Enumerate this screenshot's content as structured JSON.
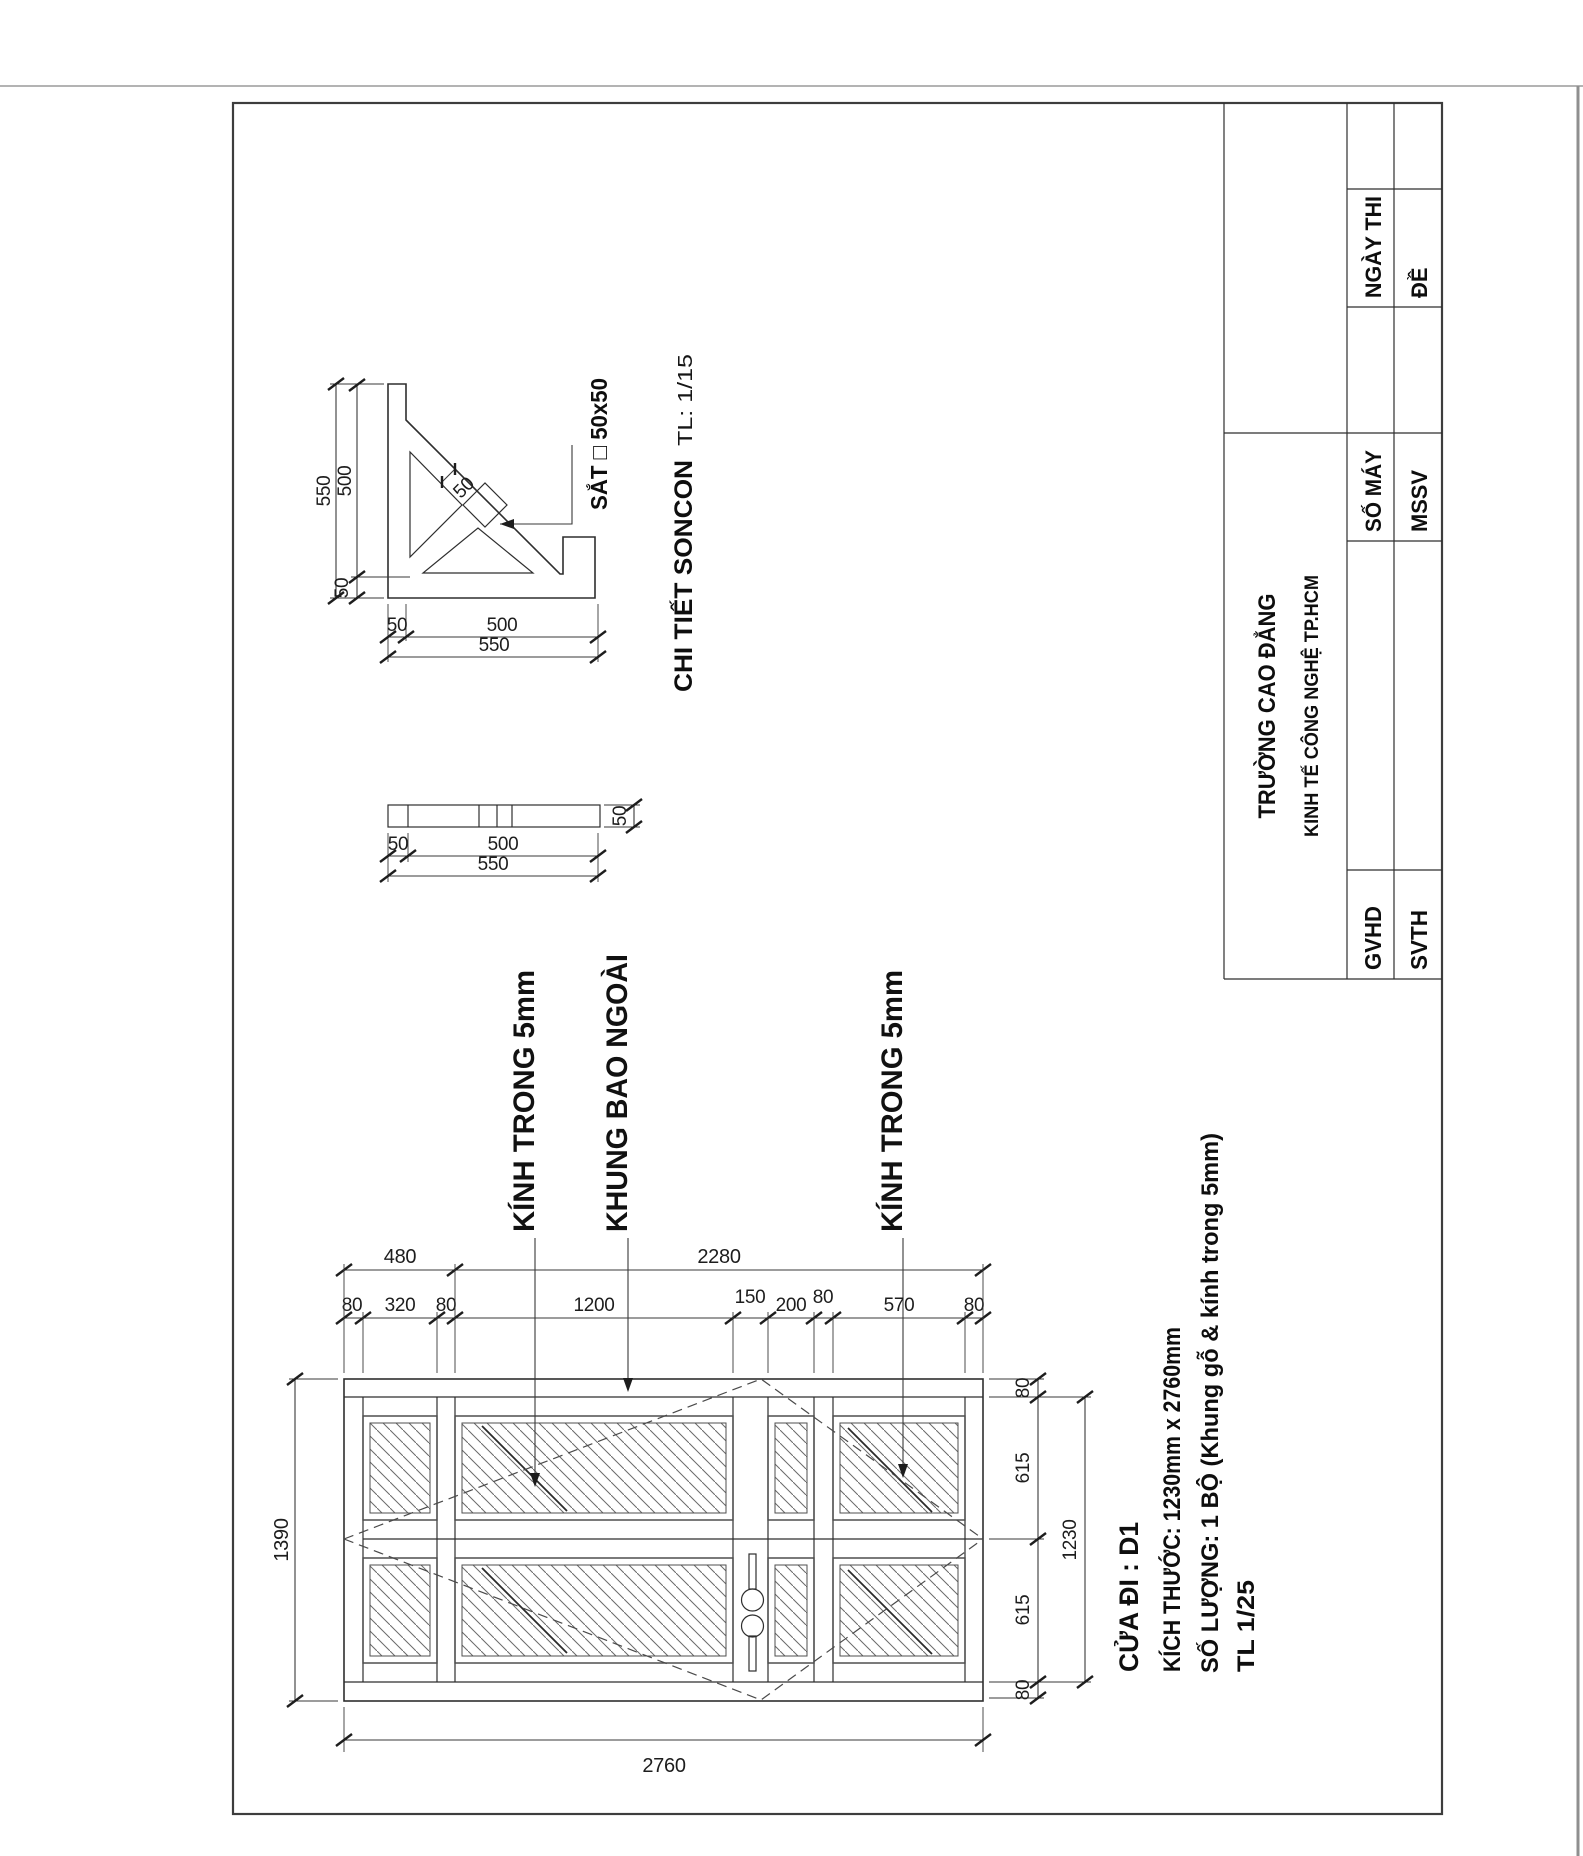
{
  "sheet": {
    "background": "#ffffff",
    "border_color": "#3d3d3d",
    "line_color": "#2e2e2e",
    "accent_text_color": "#0e0e0e"
  },
  "title_block": {
    "school_line1": "TRƯỜNG CAO ĐẲNG",
    "school_line2": "KINH TẾ CÔNG NGHỆ TP.HCM",
    "ngay_thi": "NGÀY THI",
    "de": "ĐỀ",
    "so_may": "SỐ MÁY",
    "mssv": "MSSV",
    "gvhd": "GVHD",
    "svth": "SVTH"
  },
  "detail": {
    "title": "CHI TIẾT SONCON",
    "scale_label": "TL: 1/15",
    "material_label": "SẮT □ 50x50",
    "bracket_dims": {
      "total_h": "550",
      "inner_h": "500",
      "small_h": "50",
      "brace_w": "50",
      "bottom_small": "50",
      "bottom_inner": "500",
      "bottom_total": "550"
    },
    "bar_dims": {
      "thickness": "50",
      "left": "50",
      "inner": "500",
      "total": "550"
    }
  },
  "door": {
    "labels": {
      "glass_left": "KÍNH TRONG 5mm",
      "frame": "KHUNG BAO NGOÀI",
      "glass_right": "KÍNH TRONG 5mm"
    },
    "dims_top_row1": [
      "480",
      "2280"
    ],
    "dims_top_row2": [
      "80",
      "320",
      "80",
      "1200",
      "150",
      "200",
      "80",
      "570",
      "80"
    ],
    "dim_left": "1390",
    "dims_right": [
      "80",
      "615",
      "615",
      "80"
    ],
    "dim_right_total": "1230",
    "dim_bottom": "2760"
  },
  "info_block": {
    "line1": "CỬA ĐI : D1",
    "line2": "KÍCH THƯỚC: 1230mm x 2760mm",
    "line3": "SỐ LƯỢNG: 1 BỘ (Khung gỗ & kính trong 5mm)",
    "line4": "TL 1/25"
  }
}
